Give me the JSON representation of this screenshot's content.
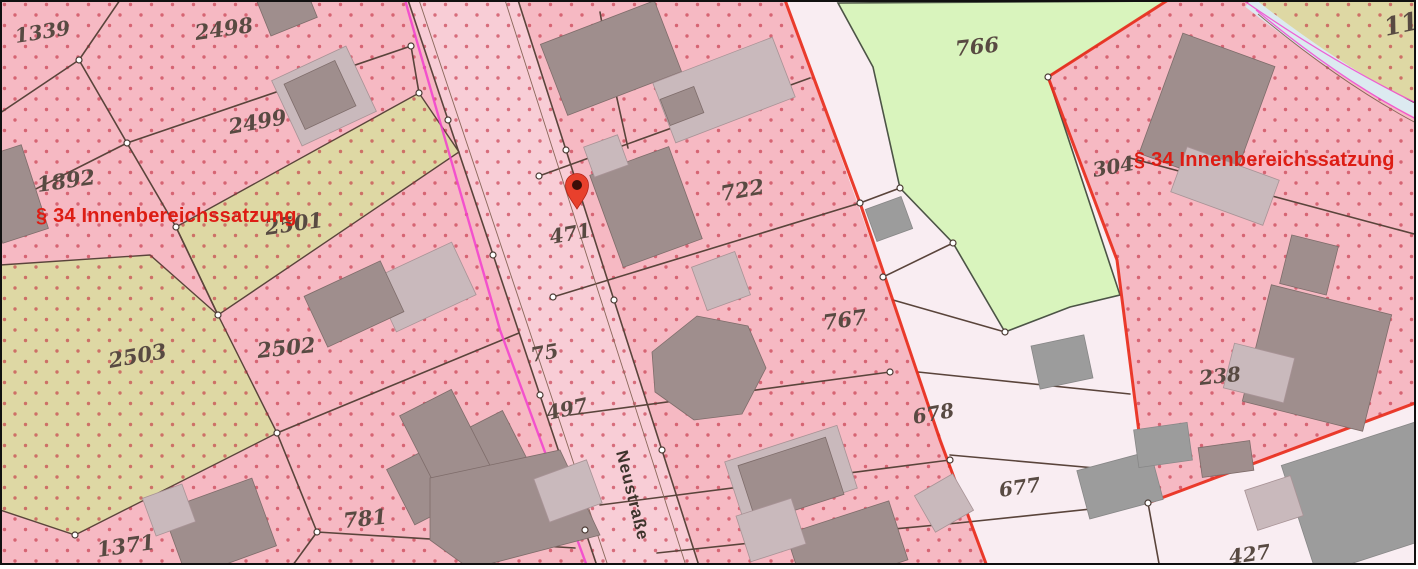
{
  "map_title": "Liegenschaftskarte",
  "street": {
    "name": "Neustraße",
    "x": 616,
    "y": 452,
    "angle": 76
  },
  "zone_labels": [
    {
      "label": "§ 34 Innenbereichssatzung",
      "x": 36,
      "y": 222
    },
    {
      "label": "§ 34 Innenbereichssatzung",
      "x": 1134,
      "y": 166
    }
  ],
  "parcel_labels": [
    {
      "label": "1339",
      "x": 16,
      "y": 43,
      "size": 20,
      "angle": -9
    },
    {
      "label": "2498",
      "x": 196,
      "y": 40,
      "size": 21,
      "angle": -8
    },
    {
      "label": "2499",
      "x": 230,
      "y": 134,
      "size": 21,
      "angle": -10
    },
    {
      "label": "1892",
      "x": 38,
      "y": 192,
      "size": 21,
      "angle": -8
    },
    {
      "label": "2501",
      "x": 266,
      "y": 235,
      "size": 21,
      "angle": -8
    },
    {
      "label": "2503",
      "x": 110,
      "y": 368,
      "size": 21,
      "angle": -10
    },
    {
      "label": "2502",
      "x": 258,
      "y": 358,
      "size": 21,
      "angle": -6
    },
    {
      "label": "1371",
      "x": 98,
      "y": 557,
      "size": 21,
      "angle": -8
    },
    {
      "label": "781",
      "x": 344,
      "y": 528,
      "size": 21,
      "angle": -6
    },
    {
      "label": "75",
      "x": 532,
      "y": 362,
      "size": 20,
      "angle": -10
    },
    {
      "label": "497",
      "x": 548,
      "y": 420,
      "size": 20,
      "angle": -12
    },
    {
      "label": "471",
      "x": 551,
      "y": 244,
      "size": 20,
      "angle": -10
    },
    {
      "label": "722",
      "x": 722,
      "y": 201,
      "size": 21,
      "angle": -10
    },
    {
      "label": "767",
      "x": 824,
      "y": 330,
      "size": 21,
      "angle": -8
    },
    {
      "label": "678",
      "x": 914,
      "y": 424,
      "size": 20,
      "angle": -10
    },
    {
      "label": "677",
      "x": 1000,
      "y": 497,
      "size": 20,
      "angle": -8
    },
    {
      "label": "766",
      "x": 956,
      "y": 56,
      "size": 21,
      "angle": -6
    },
    {
      "label": "304",
      "x": 1094,
      "y": 177,
      "size": 20,
      "angle": -10
    },
    {
      "label": "238",
      "x": 1200,
      "y": 385,
      "size": 20,
      "angle": -6
    },
    {
      "label": "427",
      "x": 1230,
      "y": 564,
      "size": 20,
      "angle": -8
    },
    {
      "label": "11",
      "x": 1386,
      "y": 36,
      "size": 25,
      "angle": -12
    }
  ],
  "pin": {
    "x": 577,
    "y": 209
  },
  "colors": {
    "pink": "#f6b9c3",
    "road_pink": "#f8cdd6",
    "olive": "#ded8a4",
    "green": "#d9f4bd",
    "white_parcel": "#f9edf2",
    "dot": "#c12c3e",
    "line": "#5a443b",
    "red_zone": "#e82c1c",
    "magenta": "#f23ecf",
    "path_band": "#dceaf0",
    "building_dark": "#9f8e8d",
    "building_light": "#c9b9bc",
    "building_gray": "#9c9c9c",
    "label": "#584a42",
    "street_label": "#3d342c",
    "zone_text": "#dd1d14",
    "pin_red": "#e8402c",
    "pin_core": "#3c0e08"
  }
}
